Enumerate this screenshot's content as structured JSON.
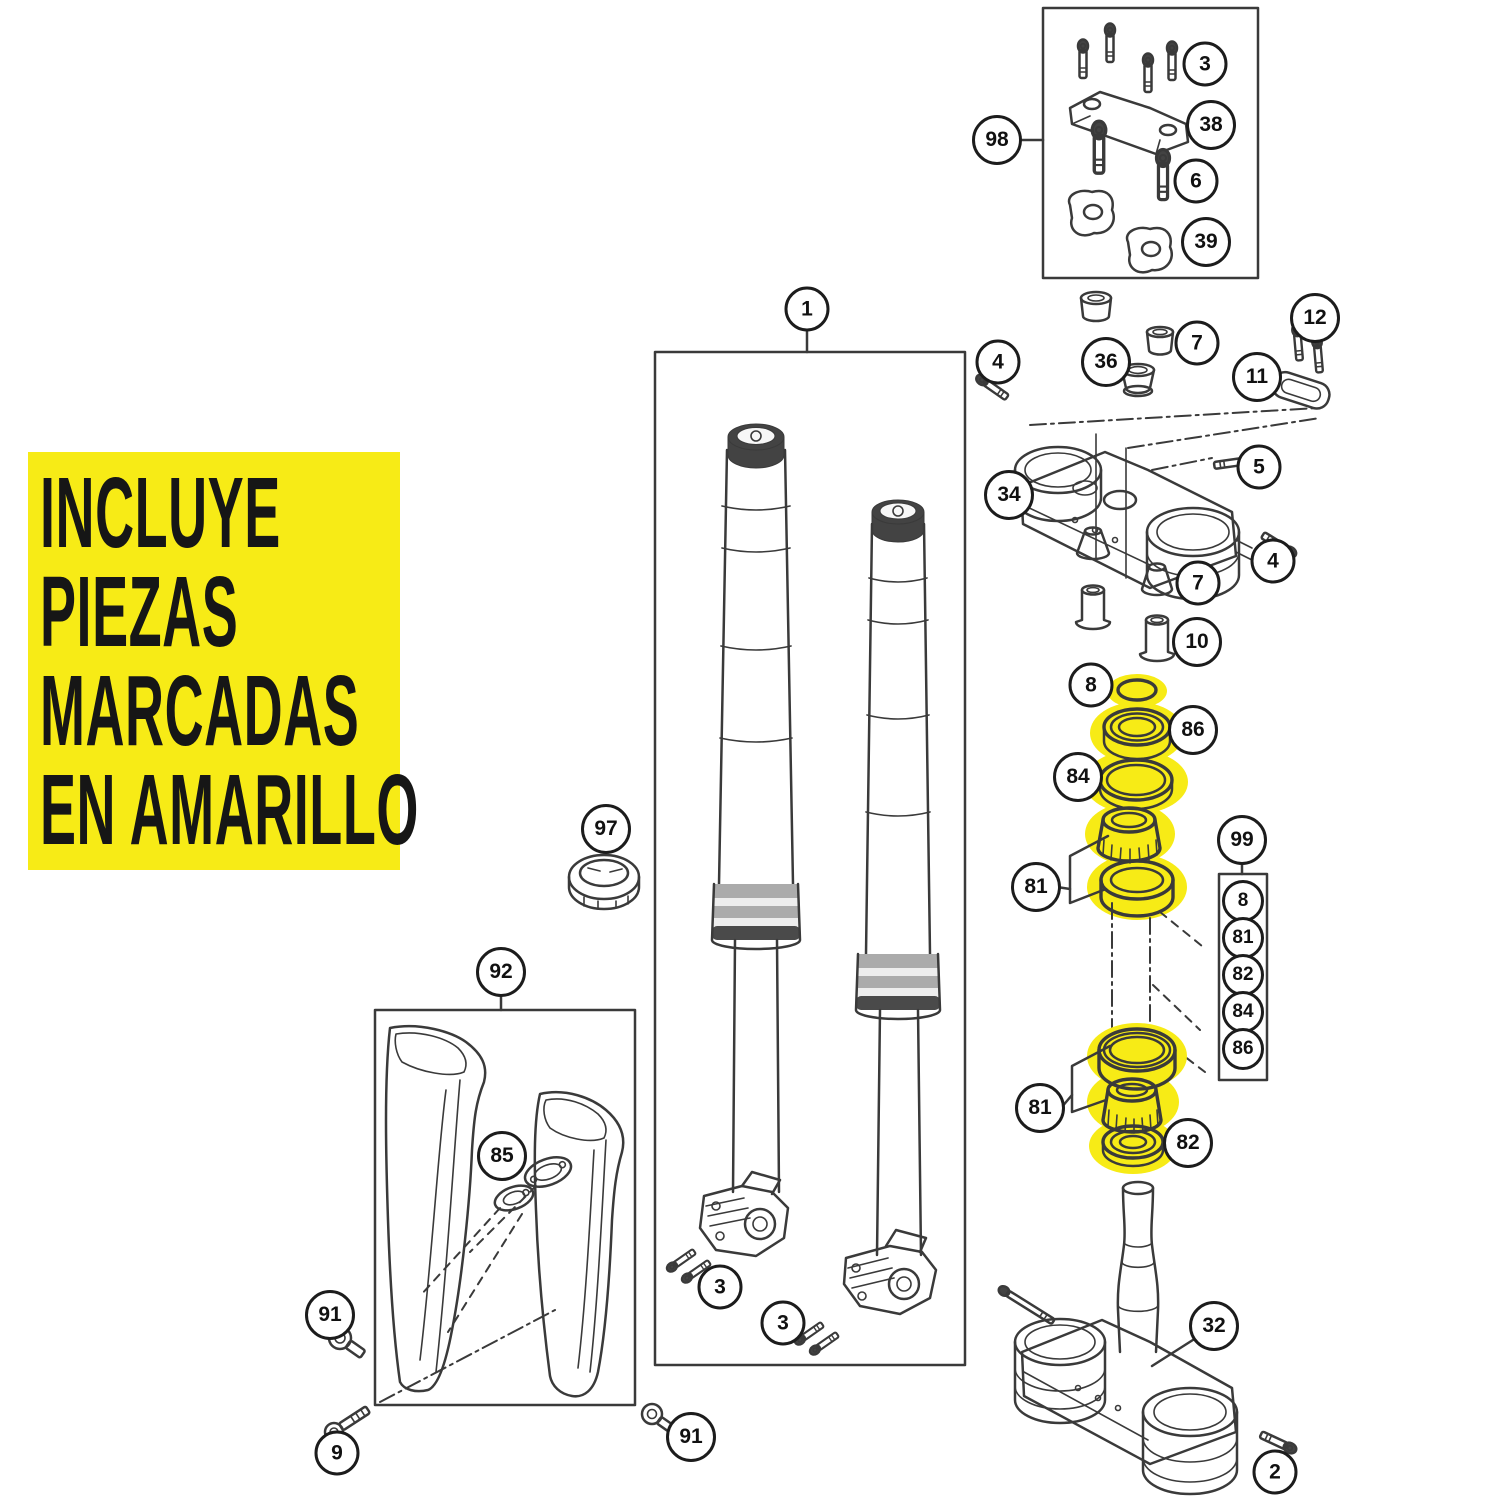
{
  "note": {
    "lines": [
      "INCLUYE",
      "PIEZAS",
      "MARCADAS",
      "EN AMARILLO"
    ]
  },
  "colors": {
    "highlight": "#F7EB16",
    "line": "#3A3A3A"
  },
  "highlighted_parts": [
    "8",
    "86",
    "84",
    "81",
    "82"
  ],
  "kit": {
    "label": "99",
    "items": [
      "8",
      "81",
      "82",
      "84",
      "86"
    ]
  },
  "callouts": [
    {
      "part": "1"
    },
    {
      "part": "98"
    },
    {
      "part": "3"
    },
    {
      "part": "38"
    },
    {
      "part": "6"
    },
    {
      "part": "39"
    },
    {
      "part": "12"
    },
    {
      "part": "36"
    },
    {
      "part": "7"
    },
    {
      "part": "11"
    },
    {
      "part": "4"
    },
    {
      "part": "5"
    },
    {
      "part": "34"
    },
    {
      "part": "4"
    },
    {
      "part": "7"
    },
    {
      "part": "10"
    },
    {
      "part": "8"
    },
    {
      "part": "86"
    },
    {
      "part": "84"
    },
    {
      "part": "81"
    },
    {
      "part": "81"
    },
    {
      "part": "82"
    },
    {
      "part": "32"
    },
    {
      "part": "2"
    },
    {
      "part": "97"
    },
    {
      "part": "92"
    },
    {
      "part": "85"
    },
    {
      "part": "91"
    },
    {
      "part": "9"
    },
    {
      "part": "91"
    },
    {
      "part": "3"
    },
    {
      "part": "3"
    }
  ]
}
